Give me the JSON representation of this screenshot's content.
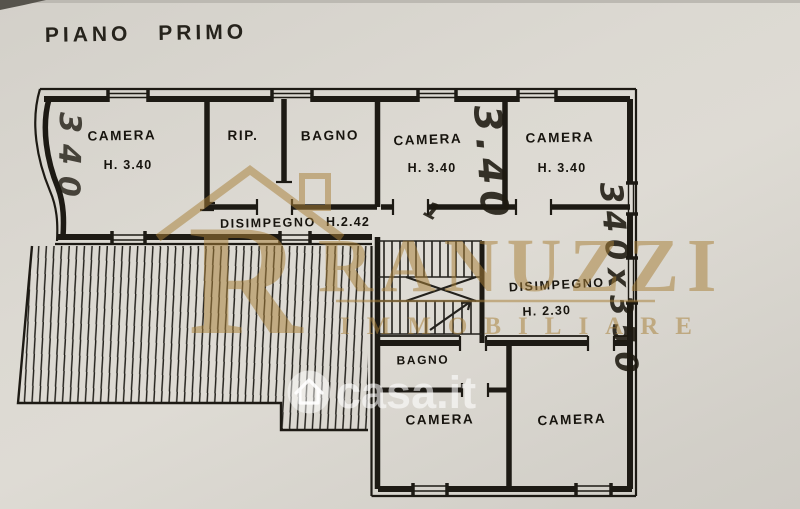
{
  "page": {
    "title": "PIANO PRIMO"
  },
  "colors": {
    "paper": "#d9d6cf",
    "ink": "#1d1a14",
    "watermark_gold": "#a9813a",
    "watermark_white": "#ffffff"
  },
  "watermarks": {
    "agency": {
      "initial": "R",
      "name": "RANUZZI",
      "subtitle": "IMMOBILIARE"
    },
    "portal": {
      "text": "casa.it",
      "icon": "house-circle-icon"
    }
  },
  "plan": {
    "rooms": [
      {
        "id": "camera-nw",
        "label": "CAMERA",
        "height": "H. 3.40"
      },
      {
        "id": "ripostiglio",
        "label": "RIP."
      },
      {
        "id": "bagno-top",
        "label": "BAGNO"
      },
      {
        "id": "camera-mid",
        "label": "CAMERA",
        "height": "H. 3.40"
      },
      {
        "id": "camera-ne",
        "label": "CAMERA",
        "height": "H. 3.40"
      },
      {
        "id": "disimpegno-upper",
        "label": "DISIMPEGNO",
        "height": "H.2.42"
      },
      {
        "id": "disimpegno-lower",
        "label": "DISIMPEGNO",
        "height": "H. 2.30"
      },
      {
        "id": "bagno-bottom",
        "label": "BAGNO"
      },
      {
        "id": "camera-sw",
        "label": "CAMERA"
      },
      {
        "id": "camera-se",
        "label": "CAMERA"
      }
    ],
    "dimensions": [
      {
        "id": "dim-left-vertical",
        "text": "340"
      },
      {
        "id": "dim-mid-vertical",
        "text": "3.40"
      },
      {
        "id": "dim-right-vertical",
        "text": "340x350"
      },
      {
        "id": "pencil-mark",
        "text": "1"
      }
    ],
    "features": [
      "terrace-hatched",
      "staircase"
    ]
  }
}
